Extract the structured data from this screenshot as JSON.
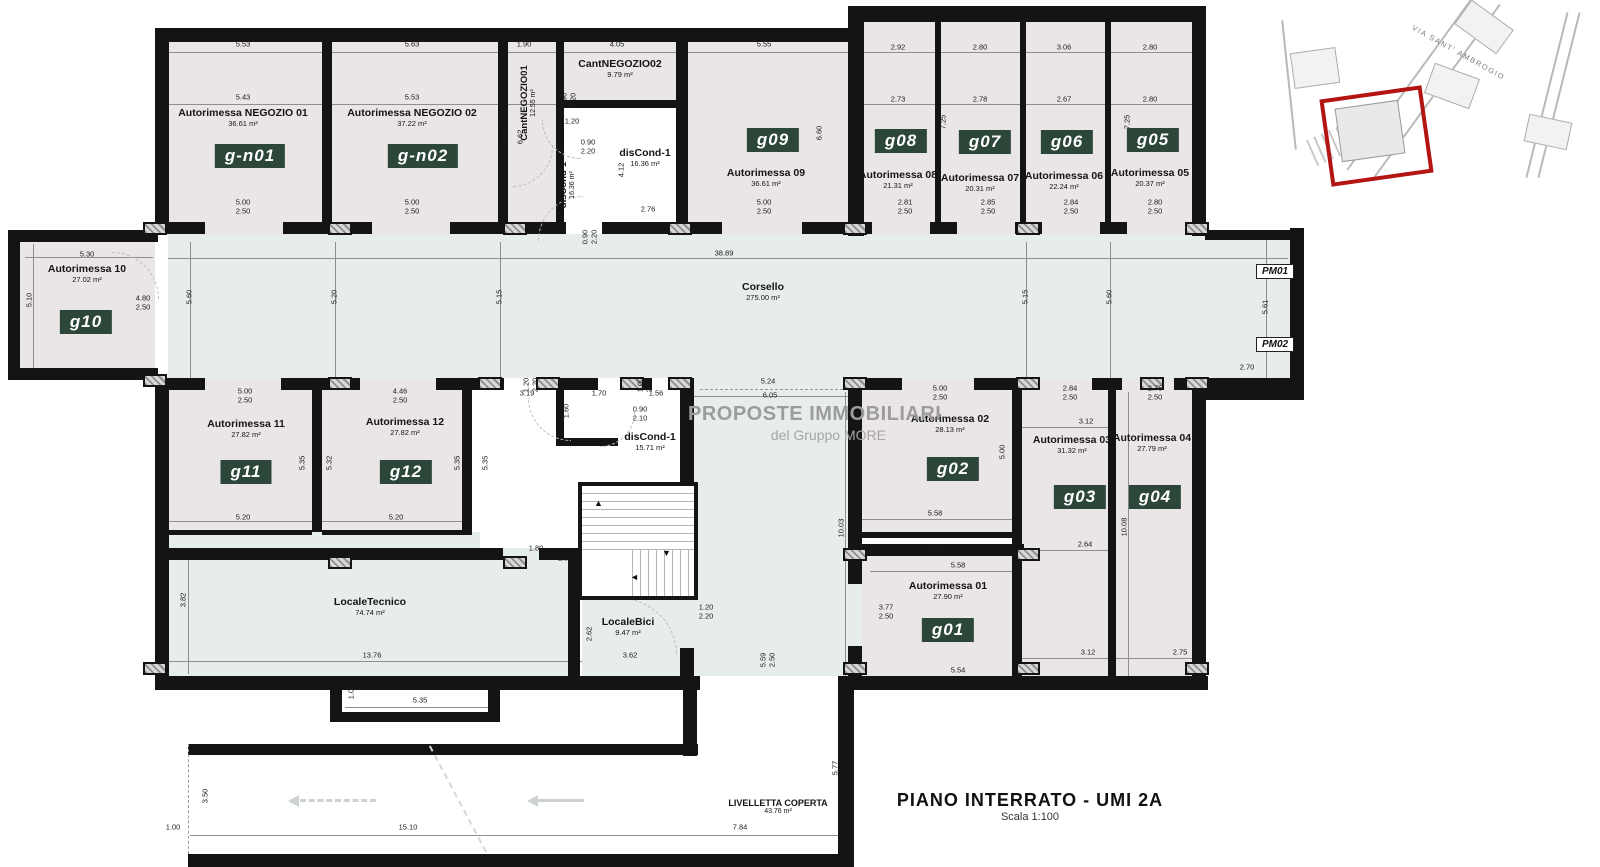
{
  "title": {
    "main": "PIANO INTERRATO - UMI 2A",
    "scale": "Scala 1:100"
  },
  "watermark": {
    "line1": "PROPOSTE IMMOBILIARI",
    "line2": "del Gruppo MORE"
  },
  "inset": {
    "street": "VIA SANT' AMBROGIO"
  },
  "markers": {
    "pm01": "PM01",
    "pm02": "PM02"
  },
  "colors": {
    "room_fill": "#eae5e7",
    "corridor_fill": "#e7edea",
    "tag_bg": "#2c4639",
    "tag_text": "#ffffff",
    "wall": "#141414",
    "inset_highlight": "#b31512",
    "watermark": "#9c9c9c"
  },
  "rooms": {
    "gn01": {
      "name": "Autorimessa NEGOZIO 01",
      "area": "36.61 m²",
      "tag": "g-n01"
    },
    "gn02": {
      "name": "Autorimessa NEGOZIO 02",
      "area": "37.22 m²",
      "tag": "g-n02"
    },
    "cant01": {
      "name": "CantNEGOZIO01",
      "area": "12.55 m²"
    },
    "cant02": {
      "name": "CantNEGOZIO02",
      "area": "9.79 m²"
    },
    "disc_top": {
      "name": "disCond-1",
      "area": "16.36 m²"
    },
    "g09": {
      "name": "Autorimessa 09",
      "area": "36.61 m²",
      "tag": "g09"
    },
    "g08": {
      "name": "Autorimessa 08",
      "area": "21.31 m²",
      "tag": "g08"
    },
    "g07": {
      "name": "Autorimessa 07",
      "area": "20.31 m²",
      "tag": "g07"
    },
    "g06": {
      "name": "Autorimessa 06",
      "area": "22.24 m²",
      "tag": "g06"
    },
    "g05": {
      "name": "Autorimessa 05",
      "area": "20.37 m²",
      "tag": "g05"
    },
    "g10": {
      "name": "Autorimessa 10",
      "area": "27.02 m²",
      "tag": "g10"
    },
    "corsello": {
      "name": "Corsello",
      "area": "275.00 m²"
    },
    "g11": {
      "name": "Autorimessa 11",
      "area": "27.82 m²",
      "tag": "g11"
    },
    "g12": {
      "name": "Autorimessa 12",
      "area": "27.82 m²",
      "tag": "g12"
    },
    "disc_mid": {
      "name": "disCond-1",
      "area": "15.71 m²"
    },
    "g02": {
      "name": "Autorimessa 02",
      "area": "28.13 m²",
      "tag": "g02"
    },
    "g03": {
      "name": "Autorimessa 03",
      "area": "31.32 m²",
      "tag": "g03"
    },
    "g04": {
      "name": "Autorimessa 04",
      "area": "27.79 m²",
      "tag": "g04"
    },
    "g01": {
      "name": "Autorimessa 01",
      "area": "27.90 m²",
      "tag": "g01"
    },
    "tecnico": {
      "name": "LocaleTecnico",
      "area": "74.74 m²"
    },
    "bici": {
      "name": "LocaleBici",
      "area": "9.47 m²"
    },
    "livelletta": {
      "name": "LIVELLETTA COPERTA",
      "area": "43.76 m²"
    }
  },
  "dims": {
    "t1": "5.53",
    "t2": "5.43",
    "t3": "5.63",
    "t4": "5.53",
    "t5": "1.90",
    "t6": "4.05",
    "t7": "5.55",
    "t8": "2.92",
    "t9": "2.73",
    "t10": "2.80",
    "t11": "2.78",
    "t12": "3.06",
    "t13": "2.67",
    "t14": "2.80",
    "t15": "2.80",
    "v660a": "6.60",
    "v662": "6.62",
    "v660b": "6.60",
    "v725a": "7.25",
    "v725b": "7.25",
    "door_gn01": "5.00\n2.50",
    "door_gn02": "5.00\n2.50",
    "door_g09": "5.00\n2.50",
    "door_g08": "2.81\n2.50",
    "door_g07": "2.85\n2.50",
    "door_g06": "2.84\n2.50",
    "door_g05": "2.80\n2.50",
    "c090a": "0.90\n2.20",
    "c120": "1.20",
    "c090b": "0.90\n2.20",
    "c412": "4.12",
    "c276": "2.76",
    "c090c": "0.90\n2.20",
    "corr3889": "38.89",
    "corr560a": "5.60",
    "corr520": "5.20",
    "corr515a": "5.15",
    "corr515b": "5.15",
    "corr560b": "5.60",
    "corr561": "5.61",
    "corr270": "2.70",
    "g10w1": "5.10",
    "g10w2": "5.30",
    "g10h": "5.10",
    "g10door": "4.80\n2.50",
    "door_g11": "5.00\n2.50",
    "door_g12": "4.46\n2.50",
    "g11h": "5.35",
    "mid532": "5.32",
    "g12h": "5.35",
    "g11w": "5.20",
    "g12w": "5.20",
    "m319": "3.19",
    "m170": "1.70",
    "m156": "1.56",
    "m160": "1.60",
    "m090210": "0.90\n2.10",
    "m120220": "1.20\n2.20",
    "m100220": "1.00\n2.20",
    "m535": "5.35",
    "m180": "1.80",
    "m524": "5.24",
    "m605": "6.05",
    "m1003": "10.03",
    "door_g02": "5.00\n2.50",
    "door_g03": "2.84\n2.50",
    "door_g04": "2.75\n2.50",
    "g02h": "5.00",
    "g02w": "5.58",
    "g02w2": "5.58",
    "g03w": "3.12",
    "g03w2": "2.64",
    "g04h": "10.08",
    "b312": "3.12",
    "b275": "2.75",
    "g01w": "5.58",
    "g01door": "3.77\n2.50",
    "g01h": "5.00",
    "g01w2": "5.54",
    "lt_h": "3.82",
    "lt_w": "13.76",
    "lt180": "1.80",
    "p100": "1.00",
    "p535": "5.35",
    "lb_h": "2.62",
    "lb_w": "3.62",
    "lb_door": "1.20\n2.20",
    "m559": "5.59\n2.50",
    "r350": "3.50",
    "r100": "1.00",
    "r1510": "15.10",
    "r784": "7.84",
    "r577": "5.77"
  }
}
